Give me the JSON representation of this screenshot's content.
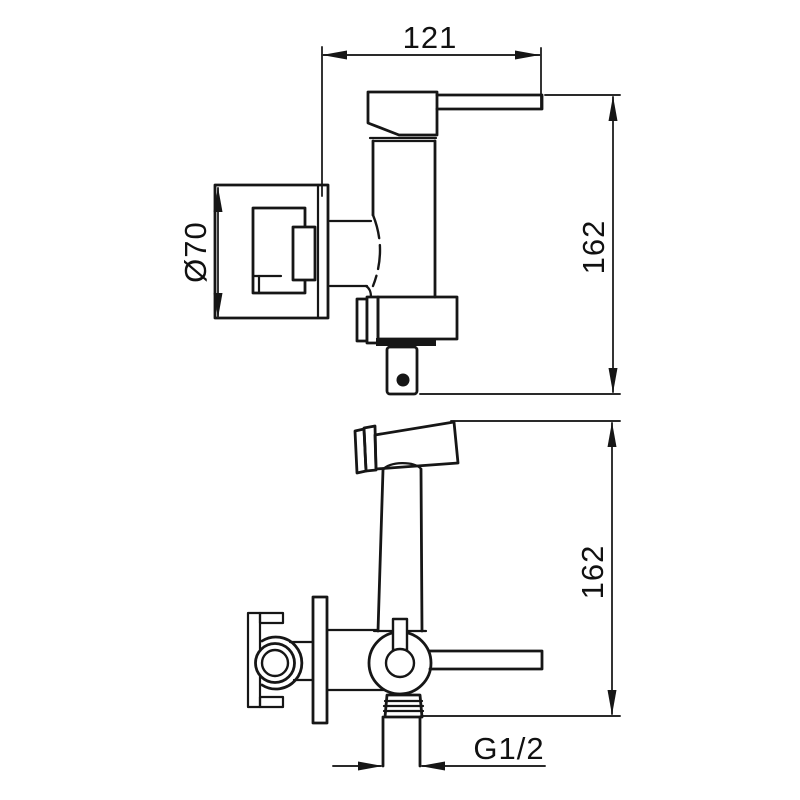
{
  "drawing": {
    "type": "faucet-installation-technical-drawing",
    "dimensions": {
      "top_width_mm": "121",
      "upper_height_mm": "162",
      "lower_height_mm": "162",
      "plate_diameter": "Ø70",
      "thread_size": "G1/2"
    }
  }
}
